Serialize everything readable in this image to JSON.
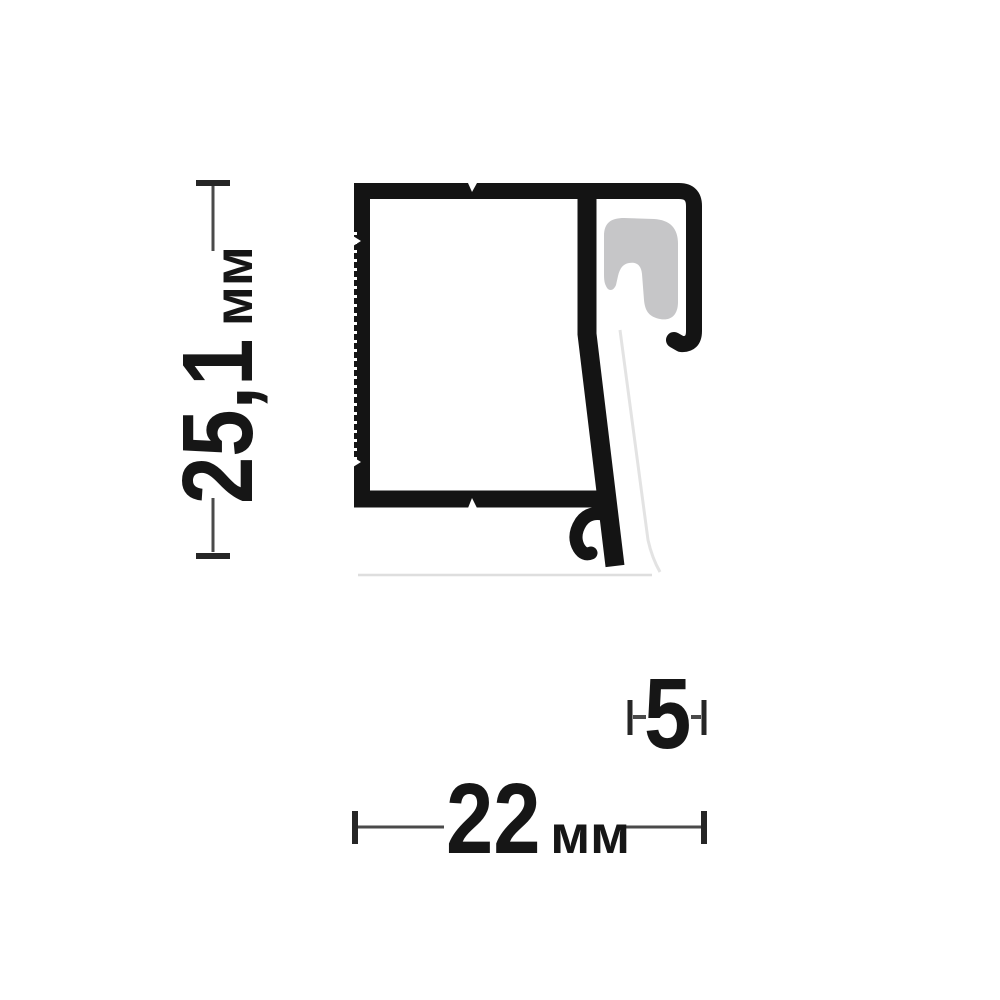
{
  "page": {
    "background": "#ffffff"
  },
  "drawing": {
    "subject": "aluminum-frame-profile-cross-section",
    "profile_color": "#141414",
    "gasket_color": "#c6c6c8",
    "shadow_color": "#dedede",
    "dimension_line_color": "#4a4a4a",
    "dimensions": {
      "height": {
        "value": "25,1",
        "unit": "мм"
      },
      "width": {
        "value": "22",
        "unit": "мм"
      },
      "hook": {
        "value": "5",
        "unit": ""
      }
    }
  }
}
